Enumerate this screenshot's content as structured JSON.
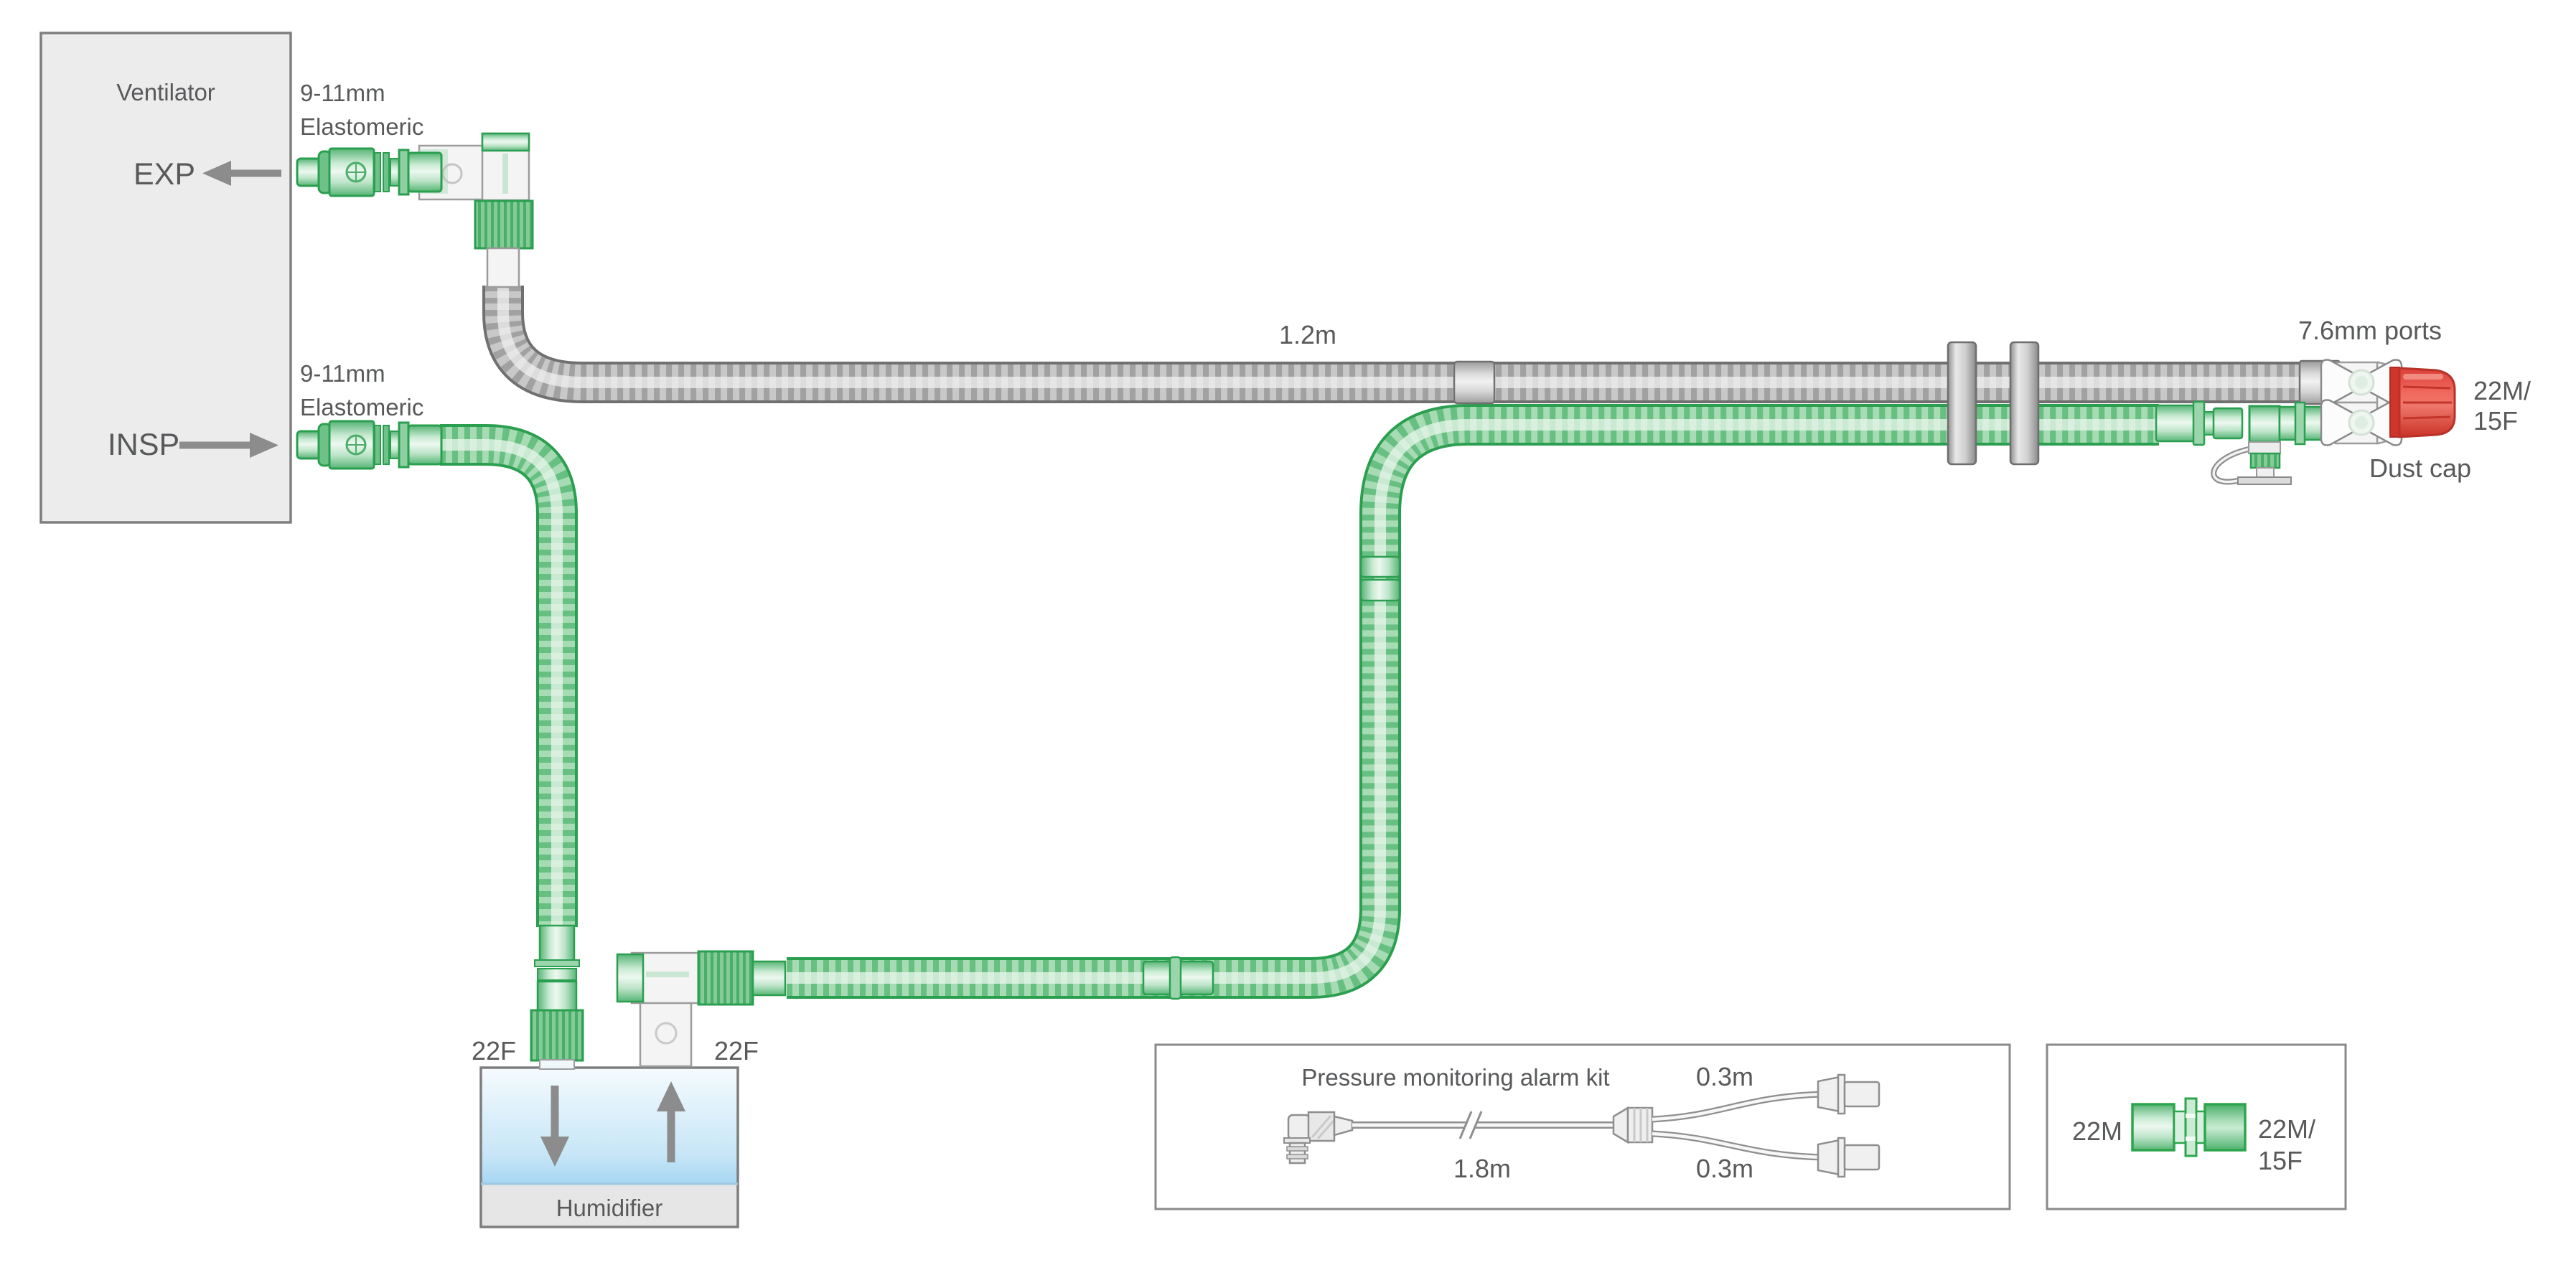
{
  "ventilator": {
    "label": "Ventilator",
    "exp_port_label": "EXP",
    "insp_port_label": "INSP"
  },
  "connectors": {
    "exp_size_line1": "9-11mm",
    "exp_size_line2": "Elastomeric",
    "insp_size_line1": "9-11mm",
    "insp_size_line2": "Elastomeric"
  },
  "circuit": {
    "limb_length_label": "1.2m",
    "monitor_ports_label": "7.6mm ports",
    "patient_connector_line1": "22M/",
    "patient_connector_line2": "15F",
    "dust_cap_label": "Dust cap"
  },
  "humidifier": {
    "label": "Humidifier",
    "inlet_port_label": "22F",
    "outlet_port_label": "22F"
  },
  "pressure_kit": {
    "title": "Pressure monitoring alarm kit",
    "main_tube_length": "1.8m",
    "top_branch_length": "0.3m",
    "bottom_branch_length": "0.3m"
  },
  "adapter": {
    "left_end_label": "22M",
    "right_end_line1": "22M/",
    "right_end_line2": "15F"
  },
  "colors": {
    "tube_green": "#2B9F50",
    "tube_gray": "#9A9A9A",
    "dust_cap_red": "#E4473D",
    "water_blue": "#A5D6F2",
    "label_text": "#58595B",
    "arrow_gray": "#8C8C8C"
  }
}
